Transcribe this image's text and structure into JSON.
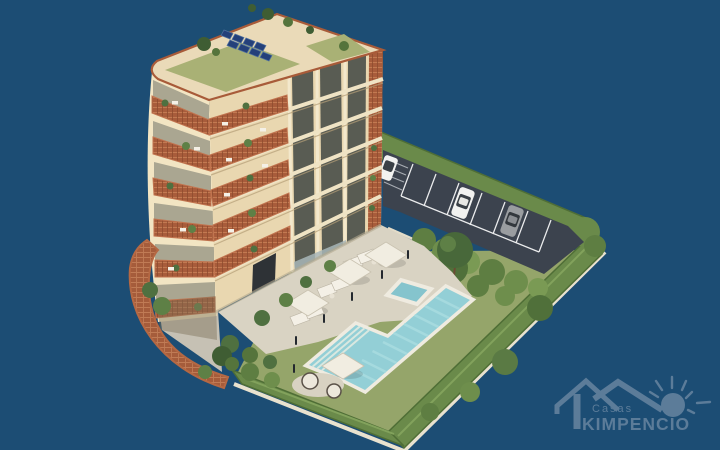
{
  "logo": {
    "brand_small": "Casas",
    "brand_large": "KIMPENCIO"
  },
  "colors": {
    "background": "#1C4D74",
    "logo": "#5C7C99",
    "building_front": "#E9D7B0",
    "building_side": "#F2E5C3",
    "terracotta": "#A85C3B",
    "roof_green": "#A9B175",
    "solar_panel": "#24407A",
    "asphalt": "#3C434E",
    "parking_line": "#FFFFFF",
    "hedge": "#6A8A4A",
    "lawn": "#95A56A",
    "deck": "#D9D3C3",
    "pool_water": "#93CFD6",
    "pool_coping": "#EFEBE0",
    "umbrella": "#F1EDE1",
    "car_white": "#F2F2F0",
    "car_gray": "#9A9DA0",
    "curb": "#E9E2CF",
    "brick_wall": "#A55C3B"
  },
  "scene": {
    "car_colors": [
      "white",
      "gray",
      "white"
    ],
    "umbrella_count": 4,
    "solar_panel_count": 8,
    "balcony_floor_count": 6
  }
}
